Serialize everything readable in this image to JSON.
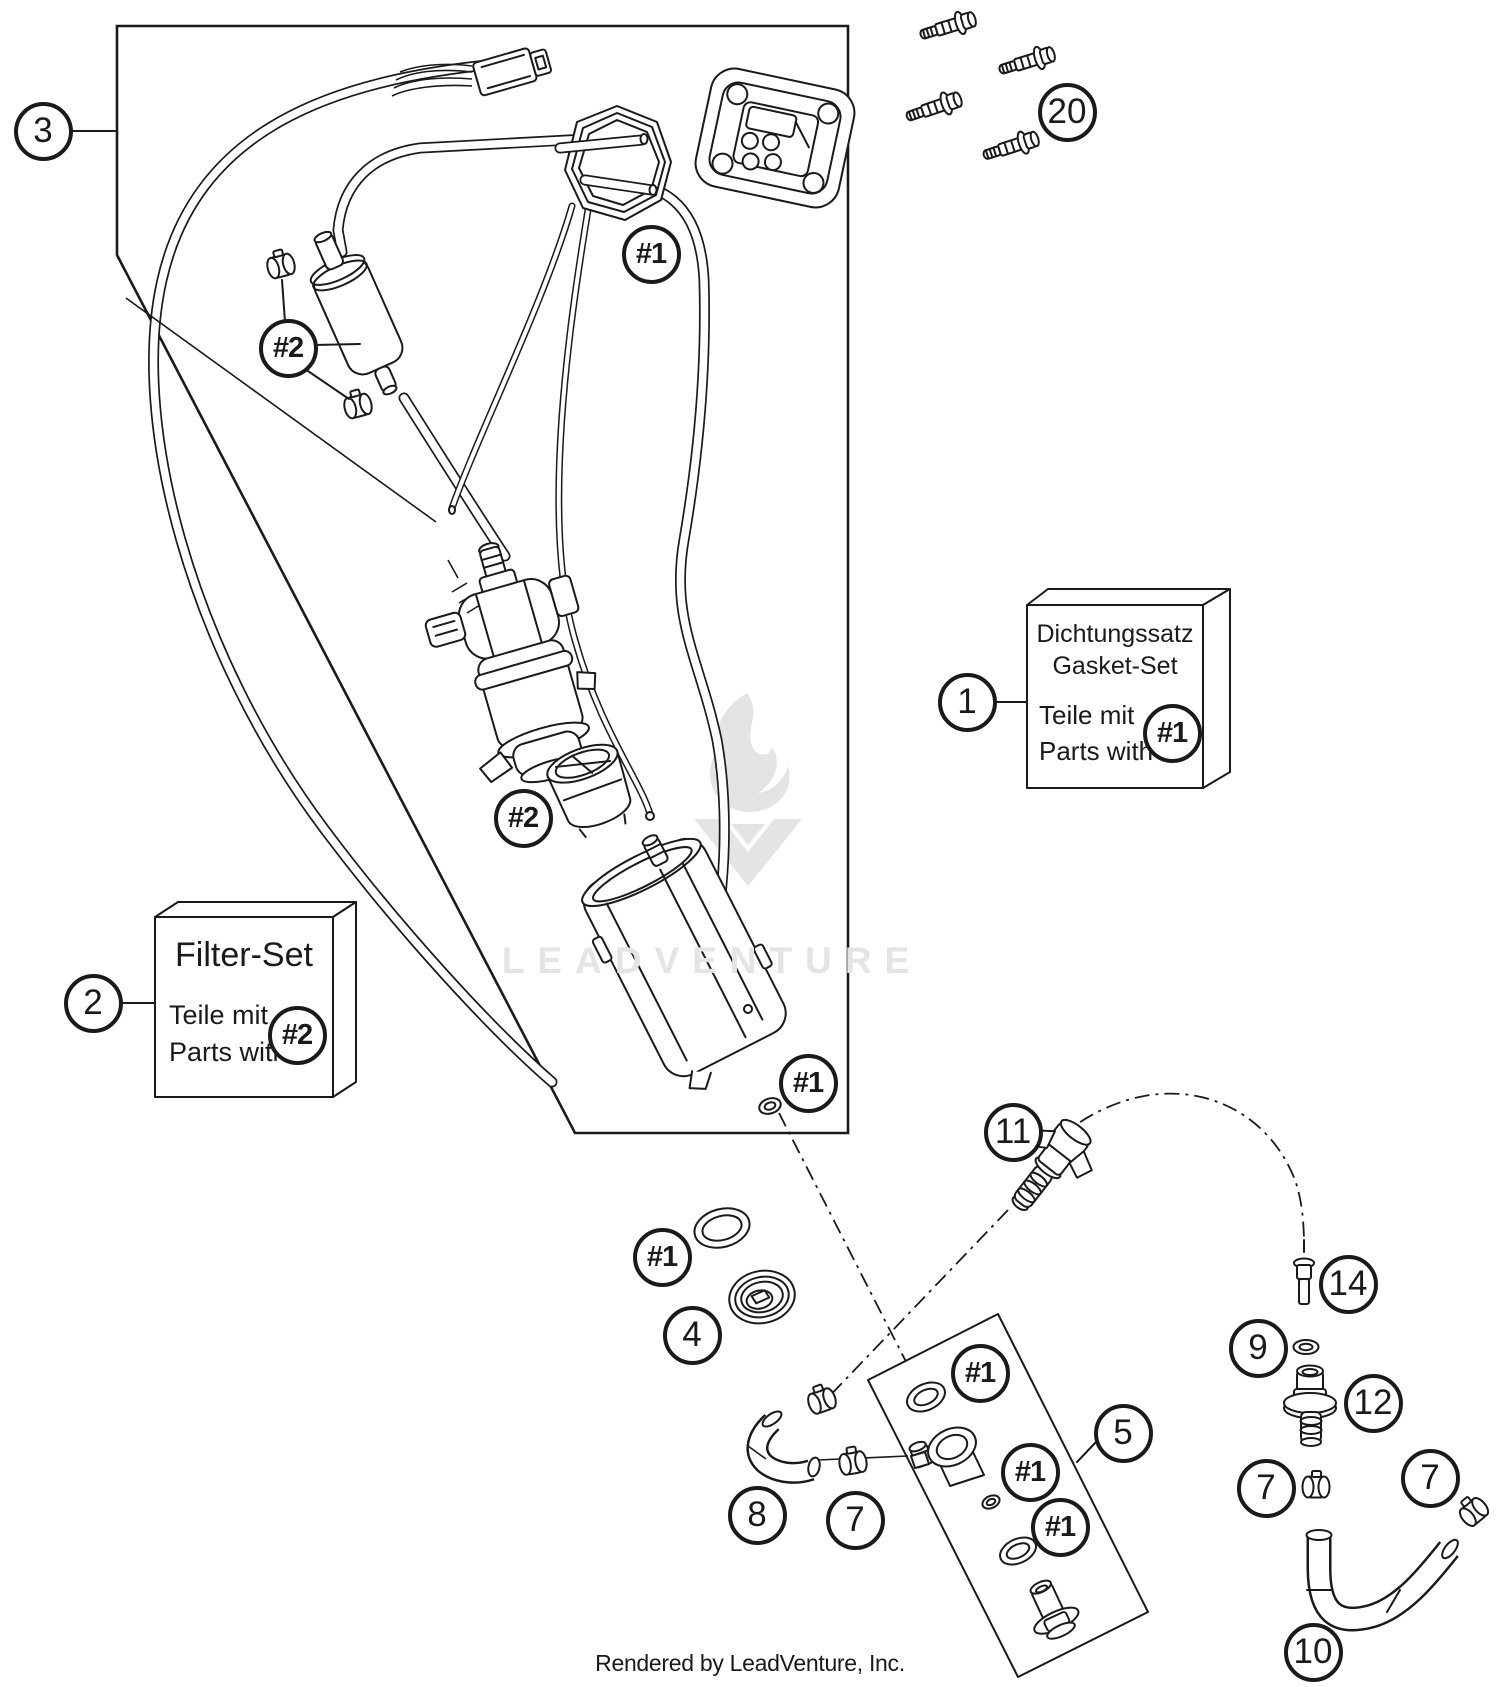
{
  "colors": {
    "line": "#1a1a1a",
    "watermark": "#e4e4e4",
    "background": "#ffffff"
  },
  "watermark": {
    "text": "LEADVENTURE",
    "logo": "flame-chevron-logo"
  },
  "footer": {
    "text": "Rendered by LeadVenture, Inc."
  },
  "kit_boxes": {
    "gasket": {
      "line1": "Dichtungssatz",
      "line2": "Gasket-Set",
      "line3": "Teile mit",
      "line4": "Parts with"
    },
    "filter": {
      "title": "Filter-Set",
      "line1": "Teile mit",
      "line2": "Parts with"
    }
  },
  "callouts": [
    {
      "id": "callout-3",
      "label": "3",
      "x": 43,
      "y": 131
    },
    {
      "id": "callout-20",
      "label": "20",
      "x": 1067,
      "y": 112
    },
    {
      "id": "ref-1-gasket-ring",
      "label": "#1",
      "x": 651,
      "y": 254
    },
    {
      "id": "ref-2-filter",
      "label": "#2",
      "x": 288,
      "y": 348
    },
    {
      "id": "callout-1",
      "label": "1",
      "x": 967,
      "y": 702
    },
    {
      "id": "ref-1-box",
      "label": "#1",
      "x": 1172,
      "y": 733
    },
    {
      "id": "callout-2",
      "label": "2",
      "x": 93,
      "y": 1003
    },
    {
      "id": "ref-2-box",
      "label": "#2",
      "x": 297,
      "y": 1035
    },
    {
      "id": "ref-2-strainer",
      "label": "#2",
      "x": 523,
      "y": 818
    },
    {
      "id": "ref-1-oring",
      "label": "#1",
      "x": 808,
      "y": 1083
    },
    {
      "id": "ref-1-sealring",
      "label": "#1",
      "x": 662,
      "y": 1257
    },
    {
      "id": "callout-4",
      "label": "4",
      "x": 692,
      "y": 1335
    },
    {
      "id": "callout-11",
      "label": "11",
      "x": 1013,
      "y": 1132
    },
    {
      "id": "callout-14",
      "label": "14",
      "x": 1348,
      "y": 1284
    },
    {
      "id": "callout-9",
      "label": "9",
      "x": 1258,
      "y": 1348
    },
    {
      "id": "callout-12",
      "label": "12",
      "x": 1373,
      "y": 1403
    },
    {
      "id": "callout-5",
      "label": "5",
      "x": 1123,
      "y": 1433
    },
    {
      "id": "ref-1-plate-a",
      "label": "#1",
      "x": 980,
      "y": 1373
    },
    {
      "id": "ref-1-plate-b",
      "label": "#1",
      "x": 1030,
      "y": 1472
    },
    {
      "id": "ref-1-plate-c",
      "label": "#1",
      "x": 1060,
      "y": 1527
    },
    {
      "id": "callout-8",
      "label": "8",
      "x": 757,
      "y": 1515
    },
    {
      "id": "callout-7-mid",
      "label": "7",
      "x": 855,
      "y": 1520
    },
    {
      "id": "callout-7-a",
      "label": "7",
      "x": 1266,
      "y": 1488
    },
    {
      "id": "callout-7-b",
      "label": "7",
      "x": 1430,
      "y": 1478
    },
    {
      "id": "callout-10",
      "label": "10",
      "x": 1313,
      "y": 1652
    }
  ]
}
